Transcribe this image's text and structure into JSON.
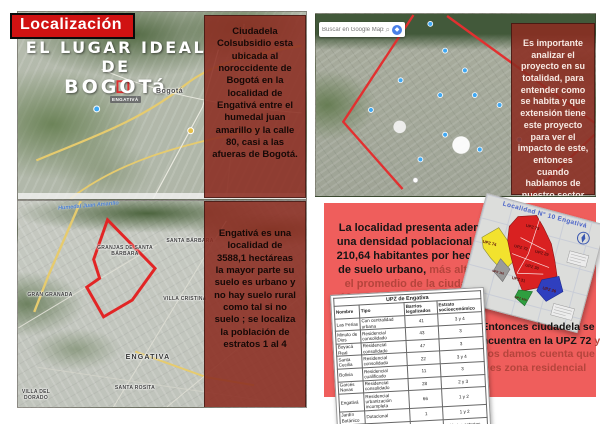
{
  "banner": {
    "title": "Localización"
  },
  "colors": {
    "banner_red": "#d01212",
    "overlay_panel_red": "#8b2c21",
    "coral_panel": "#ef5e5c",
    "muted_red_text": "#b5443c",
    "map_outline_red": "#e03131"
  },
  "left_top_map": {
    "headline_line1": "EL LUGAR IDEAL DE",
    "headline_line2": "BOGOTá",
    "city_label": "Bogotá",
    "district_label": "ENGATIVÁ"
  },
  "panel_ciudadela": {
    "text": "Ciudadela Colsubsidio esta ubicada al noroccidente de Bogotá en la localidad de Engativá  entre el humedal juan amarillo y la calle 80, casi a las afueras de Bogotá."
  },
  "left_bottom_map": {
    "wetland_label": "Humedal Juan Amarillo",
    "labels": [
      "GRANJAS DE SANTA BÁRBARA",
      "SANTA BÁRBARA",
      "GRAN GRANADA",
      "VILLA CRISTINA",
      "ENGATIVA",
      "SANTA ROSITA",
      "VILLA DEL DORADO"
    ]
  },
  "panel_engativa": {
    "text": "Engativá es una localidad de 3588,1 hectáreas la mayor parte su suelo es urbano y no hay suelo rural como tal si no suelo ; se localiza la población de estratos  1 al 4"
  },
  "right_map": {
    "search_placeholder": "Buscar en Google Maps"
  },
  "panel_proyecto": {
    "text": "Es importante analizar el proyecto en su totalidad, para entender como se habita y que extensión tiene este proyecto para ver el impacto de este, entonces cuando hablamos de nuestro sector de estudio."
  },
  "density_panel": {
    "lead_black": "La localidad presenta además una densidad poblacional alta, 210,64 habitantes por hectárea de suelo urbano,",
    "lead_red": " más alta que el promedio de la ciudad de 180,9 habitantes por hectárea",
    "conclusion_black": "Entonces ciudadela se encuentra en la UPZ 72",
    "conclusion_red": " y nos damos cuenta que es zona residencial"
  },
  "upz_table": {
    "title": "UPZ de Engativa",
    "headers": [
      "Nombre",
      "Tipo",
      "Barrios legalizados",
      "Estrato socioeconómico"
    ],
    "rows": [
      [
        "Las Ferias",
        "Con centralidad urbana",
        "41",
        "3 y 4"
      ],
      [
        "Minuto de Dios",
        "Residencial consolidado",
        "43",
        "3"
      ],
      [
        "Boyacá Real",
        "Residencial consolidado",
        "47",
        "3"
      ],
      [
        "Santa Cecilia",
        "Residencial consolidado",
        "22",
        "3 y 4"
      ],
      [
        "Bolivia",
        "Residencial cualificado",
        "11",
        "3"
      ],
      [
        "Garcés Navas",
        "Residencial consolidado",
        "28",
        "2 y 3"
      ],
      [
        "Engativá",
        "Residencial urbanización incompleta",
        "66",
        "1 y 2"
      ],
      [
        "Jardín Botánico",
        "Dotacional",
        "1",
        "1 y 2"
      ],
      [
        "Álamos",
        "Predominante industrial",
        "11",
        "Varios estratos"
      ]
    ]
  },
  "upz_map": {
    "title": "Localidad N° 10 Engativá",
    "zones": [
      {
        "label": "UPZ 74",
        "color": "#f2e22e"
      },
      {
        "label": "UPZ 73",
        "color": "#d92121"
      },
      {
        "label": "UPZ 72",
        "color": "#d92121"
      },
      {
        "label": "UPZ 29",
        "color": "#d92121"
      },
      {
        "label": "UPZ 30",
        "color": "#d92121"
      },
      {
        "label": "UPZ 31",
        "color": "#d92121"
      },
      {
        "label": "UPZ 116",
        "color": "#9a9a9a"
      },
      {
        "label": "UPZ 26",
        "color": "#2f3fbf"
      },
      {
        "label": "UPZ 105",
        "color": "#2f9e3f"
      }
    ]
  }
}
